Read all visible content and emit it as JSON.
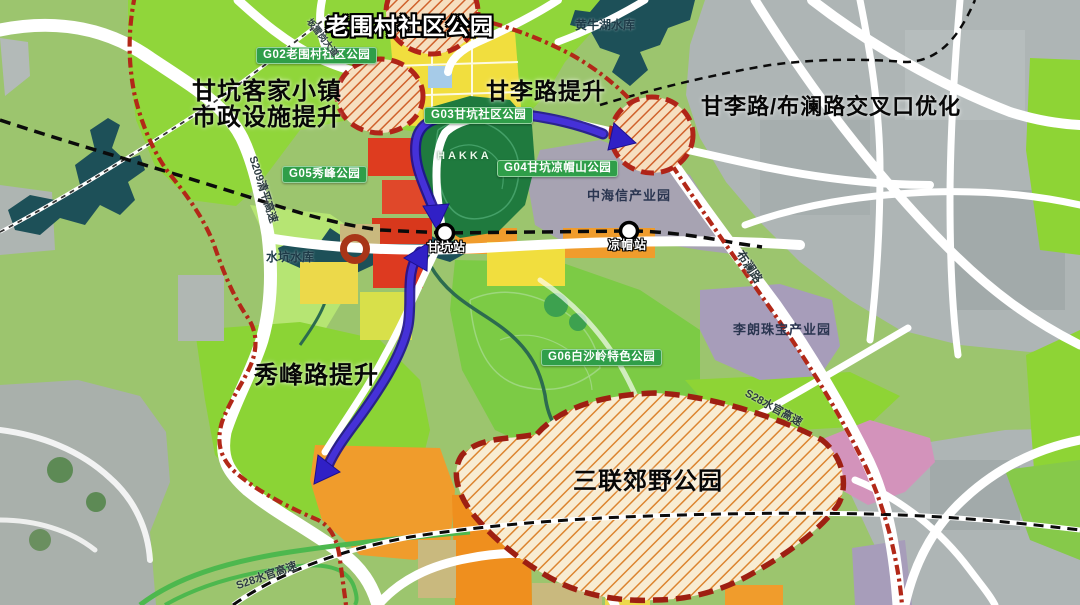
{
  "annotations": {
    "laoweicun": "老围村社区公园",
    "gankeng_town_line1": "甘坑客家小镇",
    "gankeng_town_line2": "市政设施提升",
    "ganli_road": "甘李路提升",
    "intersection": "甘李路/布澜路交叉口优化",
    "xiufeng_road": "秀峰路提升",
    "sanlian_park": "三联郊野公园"
  },
  "park_labels": {
    "g02": "G02老围村社区公园",
    "g03": "G03甘坑社区公园",
    "g04": "G04甘坑凉帽山公园",
    "g05": "G05秀峰公园",
    "g06": "G06白沙岭特色公园"
  },
  "place_labels": {
    "huangniu_reservoir": "黄牛湖水库",
    "shuikeng_reservoir": "水坑水库",
    "zhonghaixin_park": "中海信产业园",
    "lilang_park": "李朗珠宝产业园",
    "hakka": "HAKKA"
  },
  "stations": {
    "gankeng": "甘坑站",
    "liangmao": "凉帽站"
  },
  "road_labels": {
    "s209": "S209清平高速",
    "banxuegang": "坂雪岗大道",
    "bulan": "布澜路",
    "s28_right": "S28水官高速",
    "s28_left": "S28水官高速"
  },
  "colors": {
    "boundary_red": "#b22818",
    "arrow_purple": "#3020c6",
    "hatch_orange": "#dc8530",
    "park_green": "#8ed435",
    "dark_park_green": "#1f7a3e",
    "water_teal": "#1d5058",
    "pill_green": "#2f9e49",
    "satellite_gray": "#aeb5b5",
    "industry_purple": "#a79dba"
  }
}
